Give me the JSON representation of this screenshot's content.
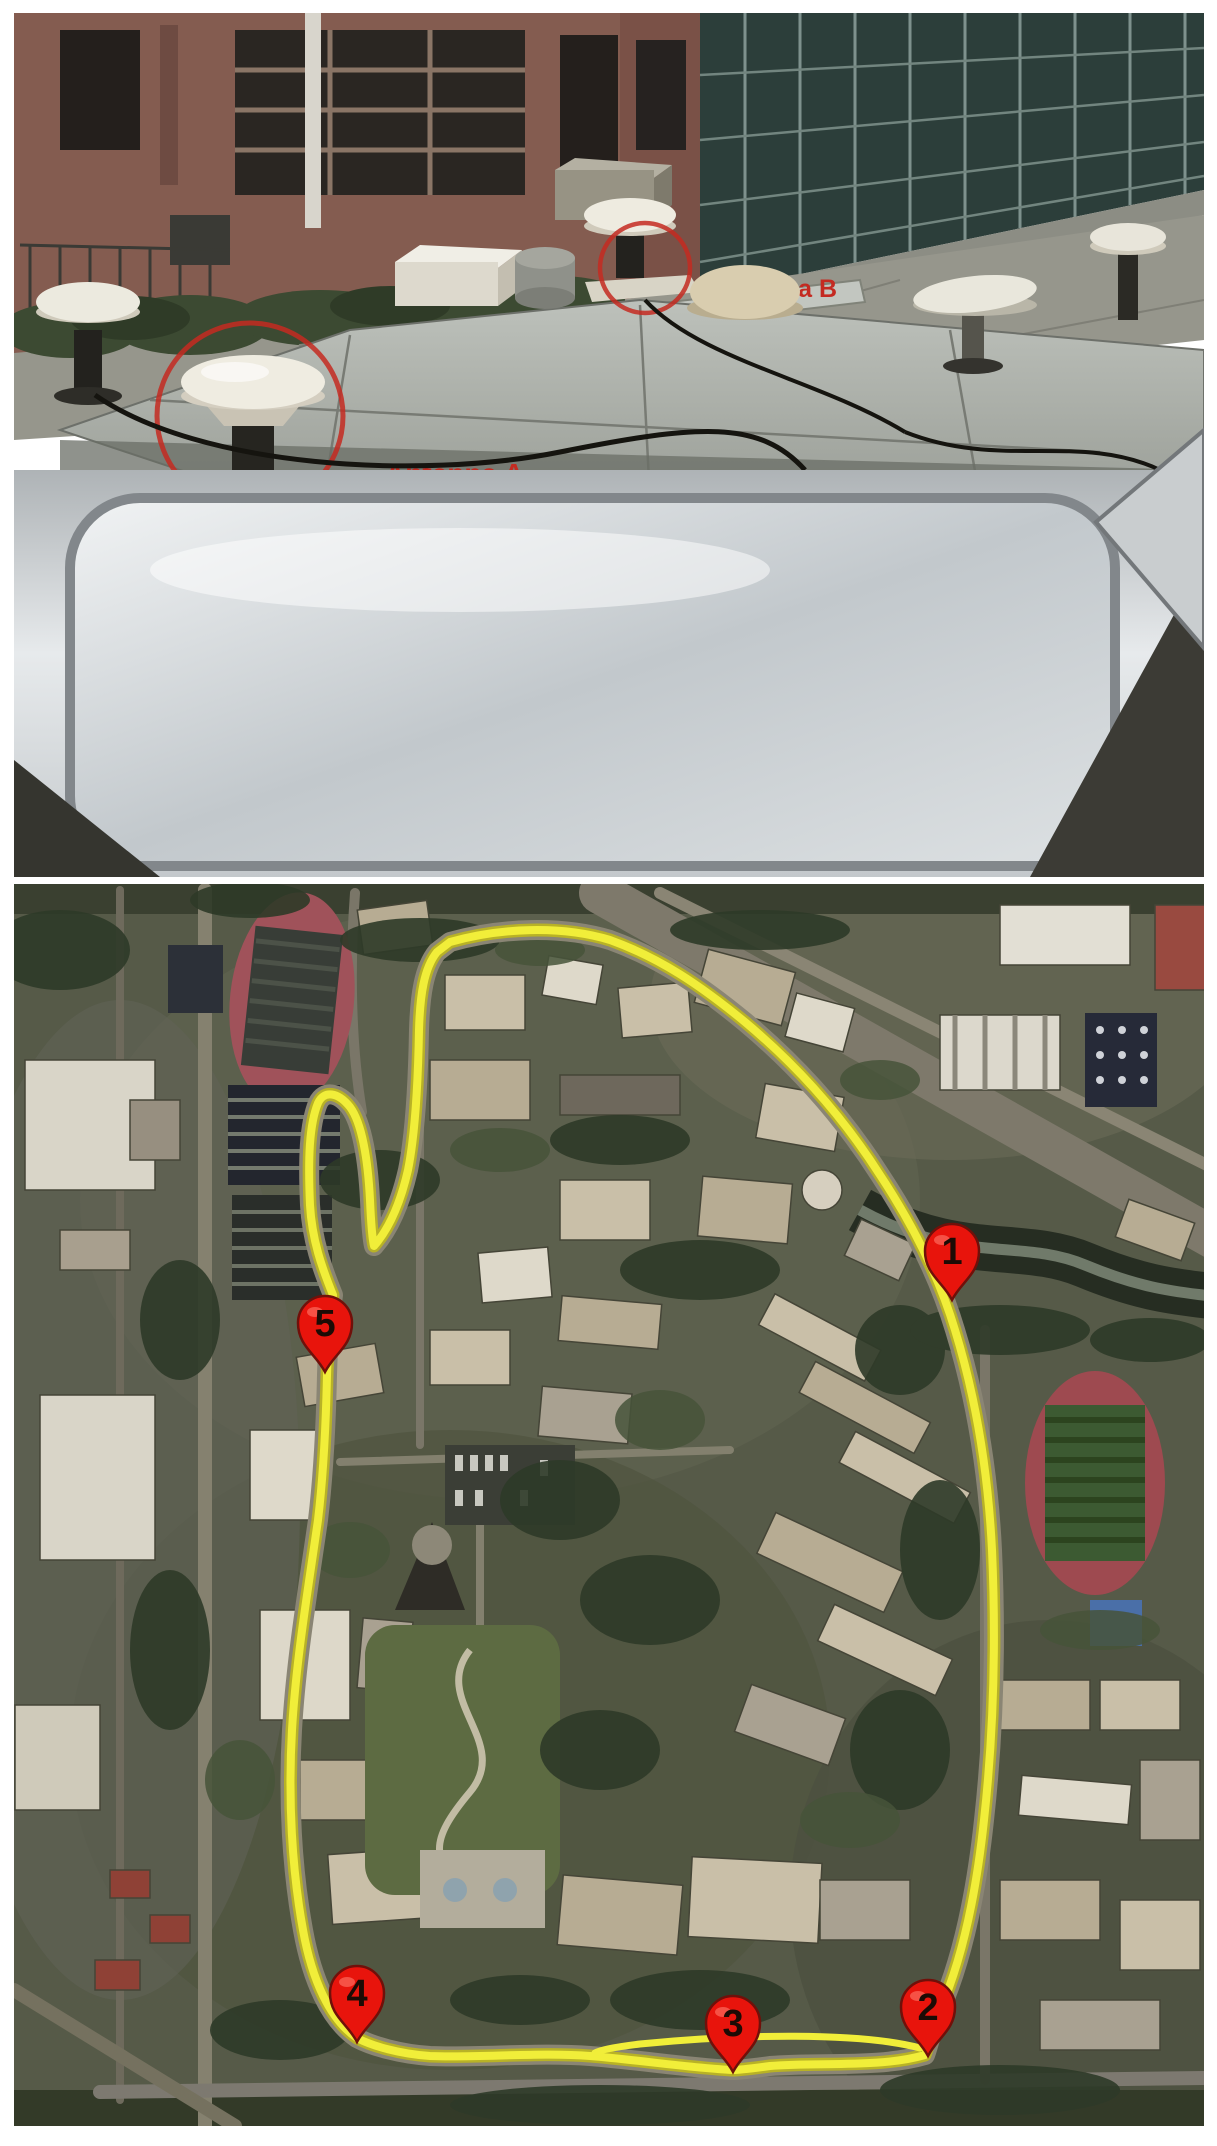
{
  "photo_panel": {
    "antenna_a_label": "Antenna A",
    "antenna_b_label": "Antenna B",
    "annotation_color": "#c42a21"
  },
  "map_panel": {
    "route_color": "#f1ee39",
    "marker_fill": "#e8140c",
    "marker_number_color": "#1c0b05",
    "markers": [
      {
        "number": "1"
      },
      {
        "number": "2"
      },
      {
        "number": "3"
      },
      {
        "number": "4"
      },
      {
        "number": "5"
      }
    ]
  }
}
